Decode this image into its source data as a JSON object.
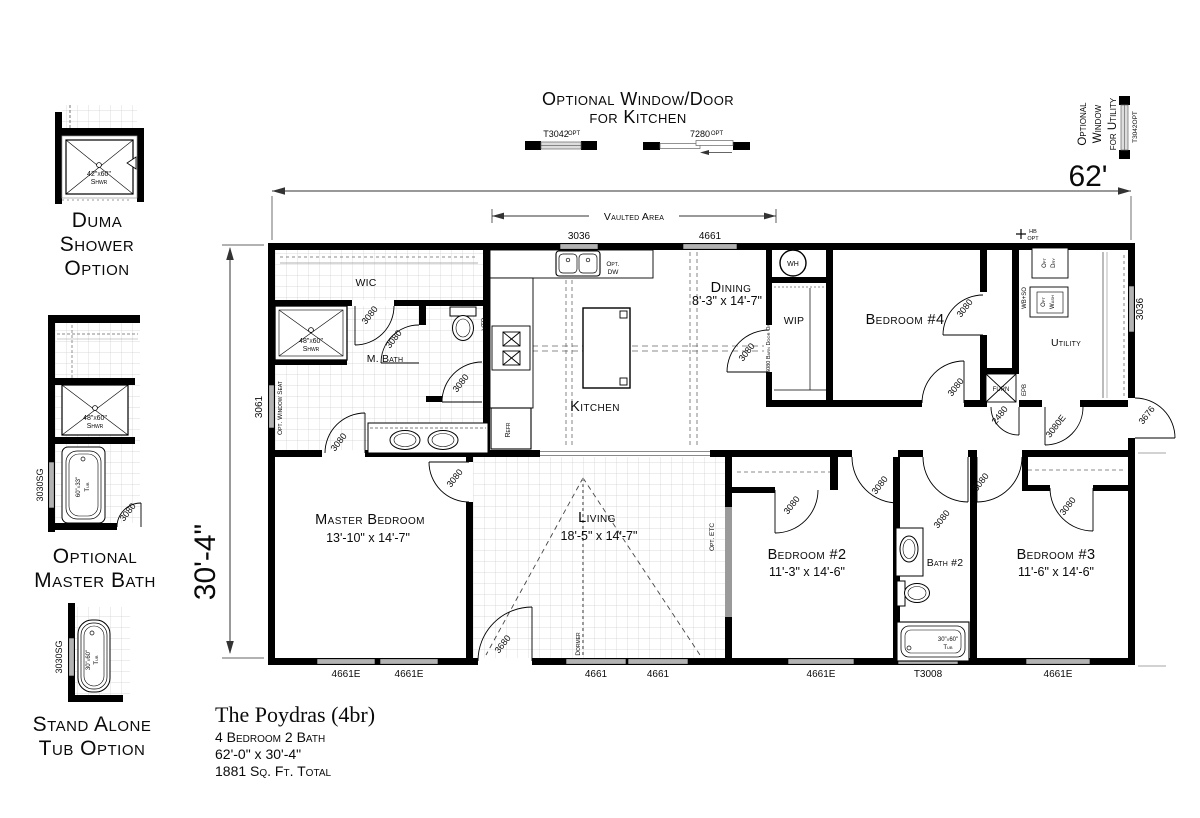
{
  "palette": {
    "paper": "#ffffff",
    "ink": "#000000",
    "grid": "#cfcfcf",
    "window_fill": "#b3b3b3"
  },
  "sidebar": {
    "duma": {
      "caption": [
        "Duma",
        "Shower",
        "Option"
      ],
      "shower_size": "42\"x60\"",
      "shower_abbr": "Shwr"
    },
    "master_bath": {
      "caption": [
        "Optional",
        "Master Bath"
      ],
      "shower_size": "48\"x60\"",
      "shower_abbr": "Shwr",
      "tub_size": "60\"x33\"",
      "tub_abbr": "Tub",
      "window_label": "3030SG",
      "door_label": "3080"
    },
    "stand_alone_tub": {
      "caption": [
        "Stand Alone",
        "Tub Option"
      ],
      "tub_size": "30\"x60\"",
      "tub_abbr": "Tub",
      "window_label": "3030SG"
    }
  },
  "header": {
    "kitchen_option": {
      "line1": "Optional Window/Door",
      "line2": "for Kitchen",
      "window_label": "T3042",
      "window_suffix": "OPT",
      "door_label": "7280",
      "door_suffix": "OPT"
    },
    "utility_option": {
      "line1": "Optional",
      "line2": "Window",
      "line3": "for Utility",
      "window_label": "T3042OPT"
    }
  },
  "dimensions": {
    "overall_width": "62'",
    "overall_depth": "30'-4\"",
    "vaulted_area": "Vaulted Area"
  },
  "rooms": {
    "wic": "WIC",
    "master_bath": "M. Bath",
    "kitchen": "Kitchen",
    "dining": {
      "name": "Dining",
      "size": "8'-3\" x 14'-7\""
    },
    "bedroom4": {
      "name": "Bedroom #4"
    },
    "wip": "WIP",
    "utility": "Utility",
    "master_bedroom": {
      "name": "Master Bedroom",
      "size": "13'-10\" x 14'-7\""
    },
    "living": {
      "name": "Living",
      "size": "18'-5\" x 14'-7\""
    },
    "bedroom2": {
      "name": "Bedroom #2",
      "size": "11'-3\" x 14'-6\""
    },
    "bath2": {
      "name": "Bath #2"
    },
    "bedroom3": {
      "name": "Bedroom #3",
      "size": "11'-6\" x 14'-6\""
    }
  },
  "fixtures": {
    "water_heater": "WH",
    "furnace": "FURN",
    "electrical_panel": "EPB",
    "refrigerator": "Refr",
    "vent": "VTR",
    "opt_dishwasher_1": "Opt.",
    "opt_dishwasher_2": "DW",
    "opt_dryer_1": "Opt",
    "opt_dryer_2": "Dry",
    "opt_washer_1": "Opt",
    "opt_washer_2": "Wash",
    "washer_box": "WB+SO",
    "hose_bib_1": "HB",
    "hose_bib_2": "OPT",
    "window_seat": "Opt. Window Seat",
    "dormer": "Dormer",
    "opt_etc": "Opt. ETC",
    "barn_door": "16080 Barn Door Opt.",
    "shower_size": "48\"x60\"",
    "shower_abbr": "Shwr",
    "tub_size": "30\"x60\"",
    "tub_abbr": "Tub"
  },
  "openings": {
    "door_3080": "3080",
    "door_3080e": "3080E",
    "door_2480": "2480",
    "door_3680": "3680",
    "door_3676": "3676",
    "window_3036": "3036",
    "window_4661": "4661",
    "window_4661e": "4661E",
    "window_t3008": "T3008",
    "window_3061": "3061"
  },
  "title_block": {
    "model_name": "The Poydras (4br)",
    "spec_beds_baths": "4 Bedroom  2 Bath",
    "spec_size": "62'-0\" x 30'-4\"",
    "spec_area": "1881 Sq. Ft. Total"
  }
}
